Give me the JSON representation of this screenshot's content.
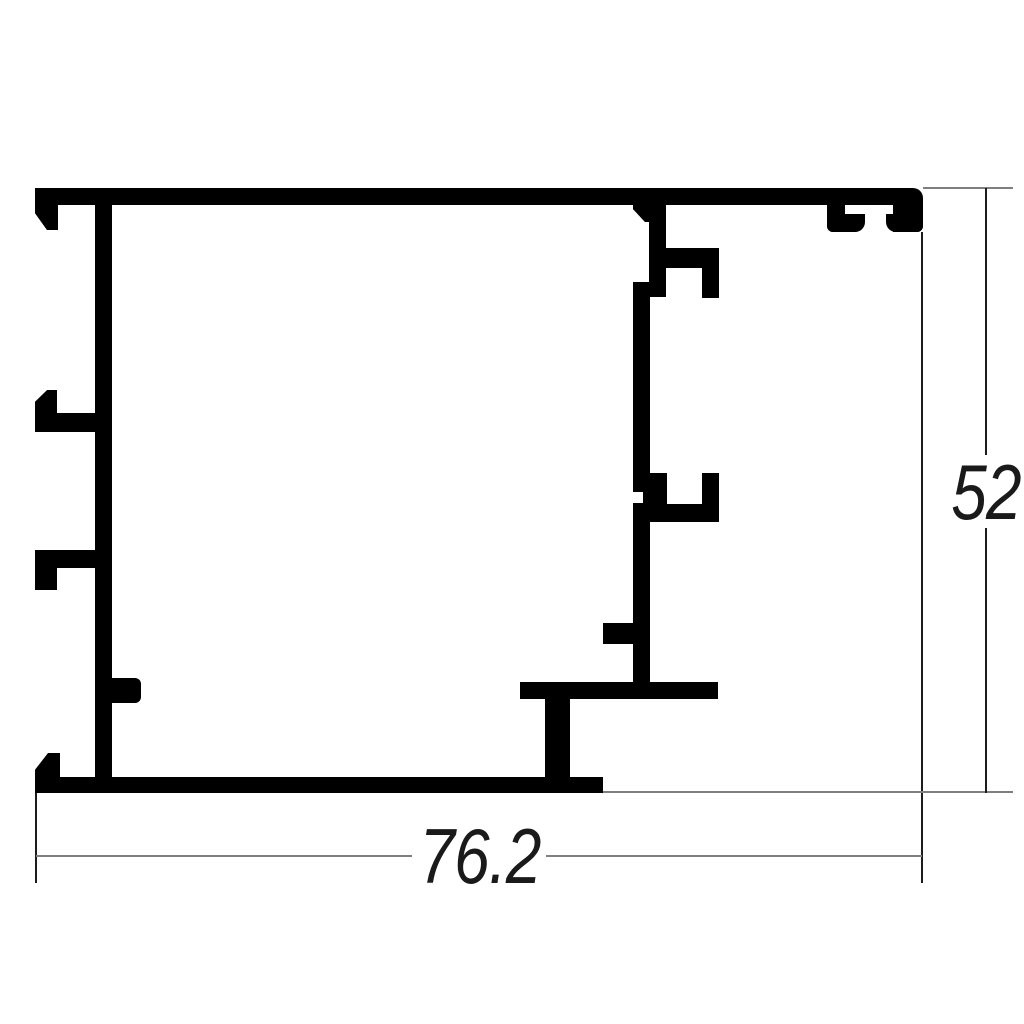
{
  "drawing": {
    "kind": "profile-cross-section"
  },
  "dimensions": {
    "width": {
      "label": "76.2"
    },
    "height": {
      "label": "52"
    }
  },
  "style": {
    "profile_color": "#000000",
    "dimension_line_color": "#7f7f7f",
    "extension_line_color": "#1c1c1c",
    "label_color": "#1a1a1a",
    "background": "#ffffff"
  }
}
